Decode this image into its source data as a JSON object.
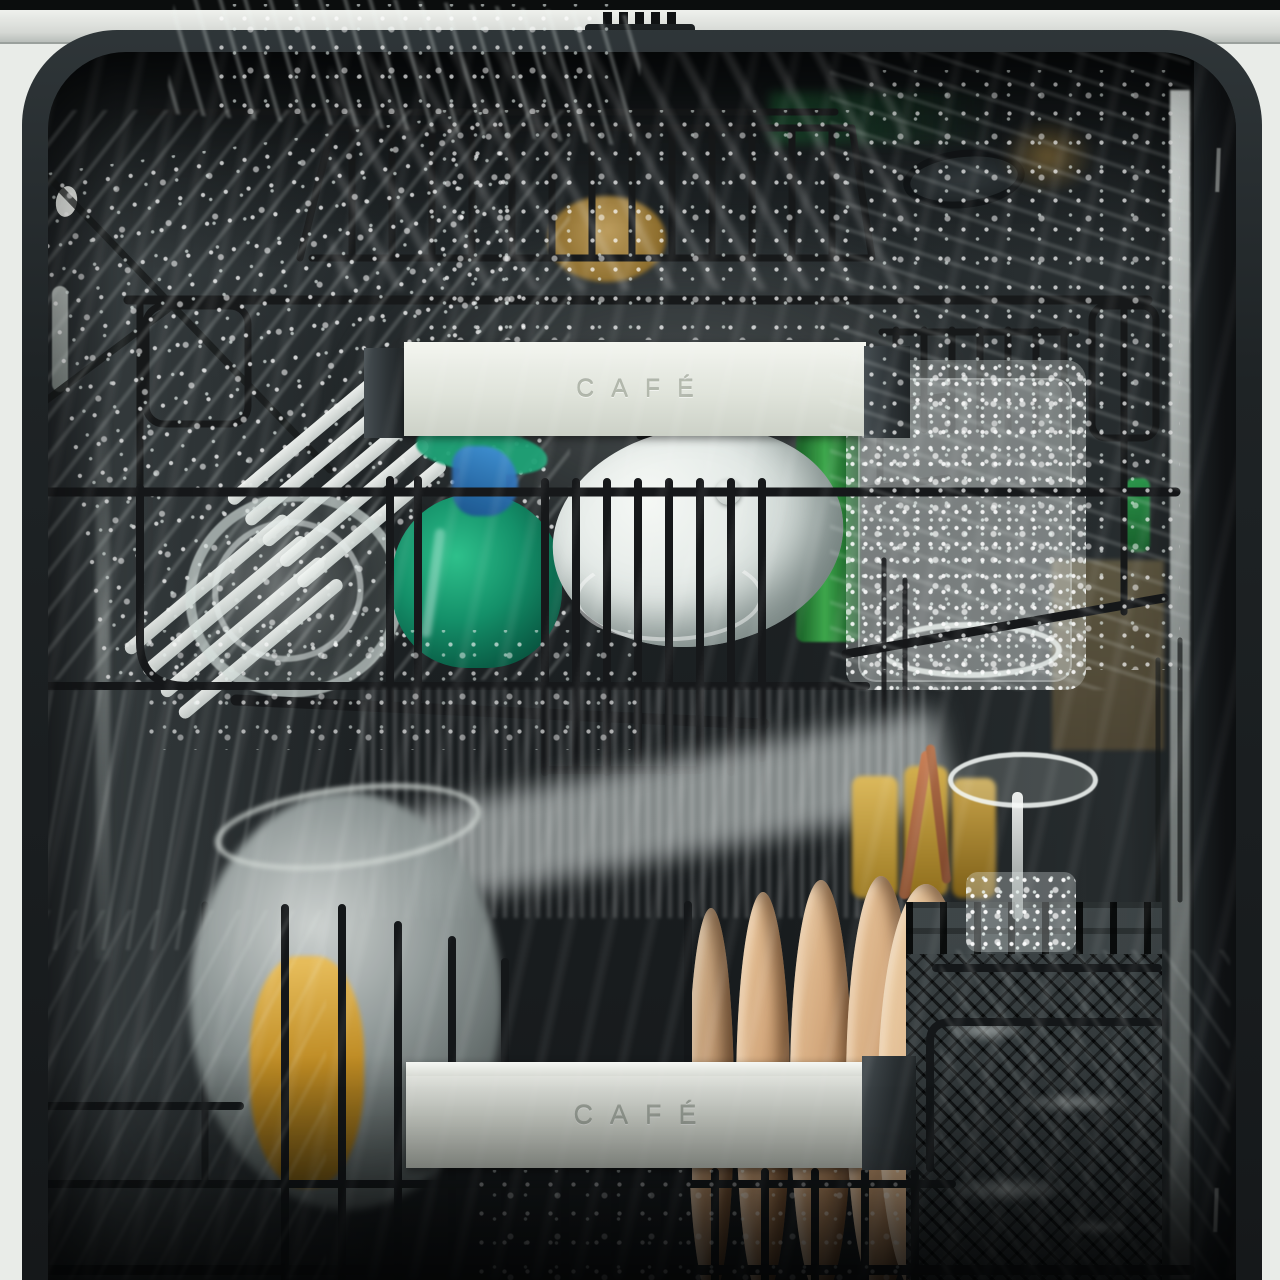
{
  "branding": {
    "upper_handle_label": "CAFÉ",
    "lower_handle_label": "CAFÉ"
  },
  "scene": {
    "subject": "dishwasher-interior-mid-wash",
    "objects": [
      "door-latch",
      "third-rack-cutlery-tray",
      "upper-rack",
      "lower-rack",
      "white-slotted-utensil",
      "clear-glass-bowl",
      "teal-glass-decanter",
      "blue-glass",
      "white-bowl-with-knob",
      "green-glass-bottle",
      "glass-tumbler-in-splash",
      "stainless-rack-handle-upper",
      "stainless-rack-handle-lower",
      "silver-pot",
      "amber-glass",
      "tan-plates-stack",
      "gold-cups",
      "copper-utensils",
      "wine-glass-upside-down",
      "silverware-basket",
      "water-spray"
    ]
  },
  "palette": {
    "outer_frame_light": "#e9ece8",
    "tub_frame_dark": "#23282b",
    "wall_mid_gray": "#6d7779",
    "rack_wire_black": "#17191a",
    "handle_silver": "#e9ece5",
    "logo_text_gray": "#b2b8ac",
    "teal_glass": "#149069",
    "green_bottle": "#2e8b3a",
    "blue_glass": "#2b6fc2",
    "tan_plate": "#d4a97e",
    "gold_cup": "#c9a44a",
    "copper_utensil": "#b4714a",
    "amber_glass": "#d99d2b",
    "water_white": "#eef5f2"
  }
}
